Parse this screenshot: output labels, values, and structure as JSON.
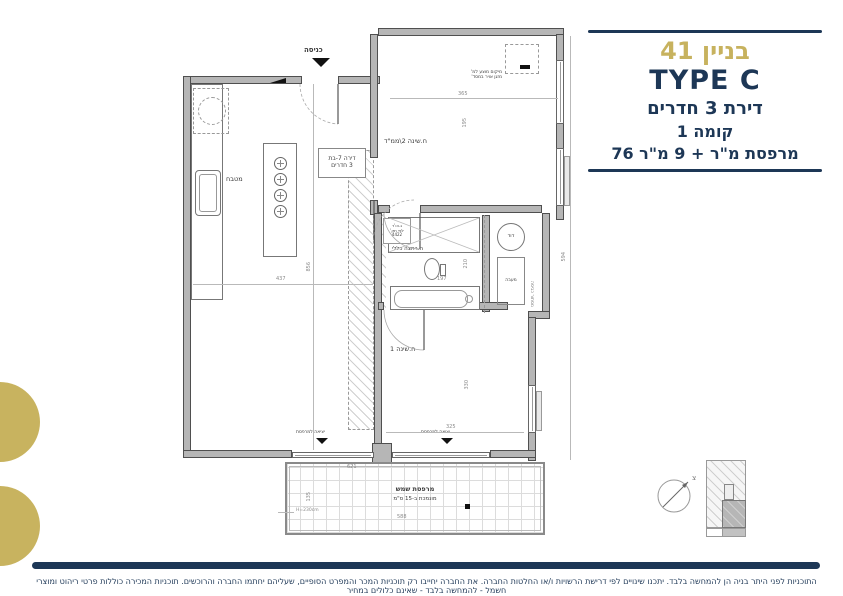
{
  "title_block": {
    "building": "בניין 41",
    "type_label": "TYPE C",
    "rooms_line": "דירת 3 חדרים",
    "floor_line": "קומה 1",
    "area_line": "76 מ\"ר + 9 מ\"ר‎ מרפסת"
  },
  "footer": {
    "disclaimer": "התוכניות לפני היתר בניה הן להמחשה בלבד. יתכנו שינויים לפי דרישת הרשויות ו/או החלטות החברה. את החברה יחייבו רק תוכניות המכר והמפרט הסופיים, שעליהם יחתמו החברה והרוכשים. תוכניות המכירה כוללות פרטי ריהוט ומוצרי חשמל - להמחשה בלבד - שאינם כלולים במחיר"
  },
  "plan": {
    "entrance_label": "כניסה",
    "rooms": {
      "kitchen": "מטבח",
      "bedroom2": "ח.שינה 2\\ממ\"ד",
      "bedroom1": "ח.שינה 1",
      "bathroom": "ח.רחצה כללי"
    },
    "apartment_tag": {
      "line1": "דירה 7-בת",
      "line2": "3 חדרים"
    },
    "balcony": {
      "line1": "מרפסת שמש",
      "line2": "מונמכת ב-15 ס\"מ"
    },
    "notes": {
      "ac_line1": "מיקום מוצע למ'",
      "ac_line2": "מזגן אויר במסד'",
      "vent_line1": "ג.הו'ר",
      "vent_line2": "לפי תק'",
      "vent_line3": "4422",
      "boiler": "דוד",
      "condenser": "מעבה",
      "laundry_screen": "מסתור כביסה",
      "exit_to_balcony": "יציאה למרפסת",
      "railing_height": "H=230cm",
      "north": "צ"
    },
    "dims": {
      "bedroom2_w": "365",
      "bedroom2_h": "195",
      "living_w": "437",
      "living_h": "856",
      "bath_h": "210",
      "bath_w": "197",
      "right_h": "594",
      "bedroom1_h": "330",
      "bedroom1_w": "325",
      "balcony_w": "621",
      "balcony_d": "135",
      "balcony_bottom": "588"
    }
  },
  "colors": {
    "navy": "#1d3756",
    "gold": "#c8b35f",
    "wall_gray": "#b6b6b6"
  }
}
